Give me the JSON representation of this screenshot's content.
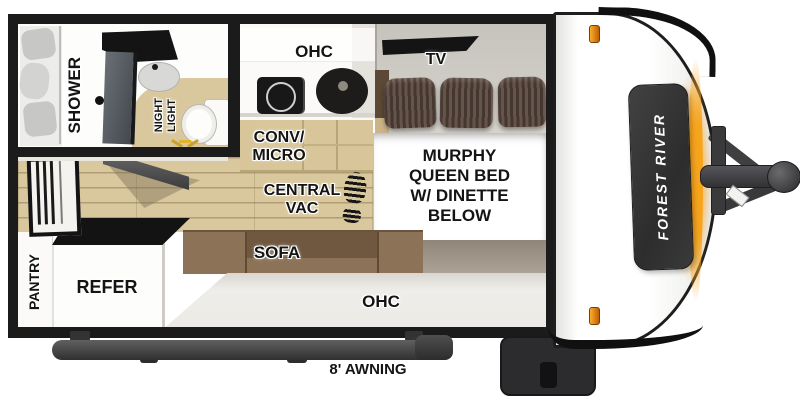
{
  "labels": {
    "shower": "SHOWER",
    "night_light": [
      "NIGHT",
      "LIGHT"
    ],
    "ohc_top": "OHC",
    "tv": "TV",
    "conv_micro": [
      "CONV/",
      "MICRO"
    ],
    "central_vac": [
      "CENTRAL",
      "VAC"
    ],
    "murphy_bed": [
      "MURPHY",
      "QUEEN BED",
      "W/ DINETTE",
      "BELOW"
    ],
    "sofa": "SOFA",
    "pantry": "PANTRY",
    "refer": "REFER",
    "ohc_bottom": "OHC",
    "awning": "8' AWNING",
    "brand": "FOREST RIVER"
  },
  "icons": {
    "footprint": "footprint-icon",
    "night_light_rays": "light-rays-icon",
    "marker_lights": "marker-light-icon",
    "cooktop": "cooktop-icon",
    "sink": "sink-icon"
  },
  "colors": {
    "wall_black": "#1b1b1b",
    "wood_floor": "#d9c79d",
    "cabinet_tan": "#d8c69a",
    "sofa_brown": "#8c7257",
    "pillow_brown": "#55453d",
    "wall_gray": "#d0cdc6",
    "taupe_band": "#a89e91",
    "accent_orange": "#f59120",
    "badge_gray": "#383838"
  }
}
